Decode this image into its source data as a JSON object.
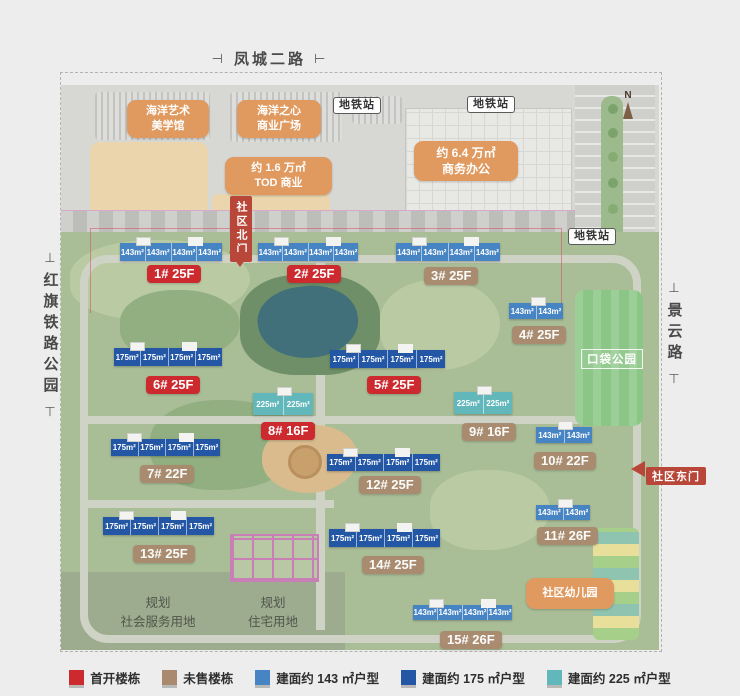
{
  "colors": {
    "first": "#cc2a2f",
    "unsold": "#a98a6e",
    "u143": "#4684c4",
    "u175": "#2357a6",
    "u225": "#62b7bb",
    "orange": "#e0995e",
    "gate": "#b8473a",
    "park": "#8cc687"
  },
  "roads": {
    "top": "凤城二路",
    "left": "红旗铁路公园",
    "right": "景云路",
    "tick_h_left": "⊣",
    "tick_h_right": "⊢",
    "tick_v_top": "⊥",
    "tick_v_bottom": "⊤"
  },
  "facilities": {
    "art_museum": "海洋艺术\n美学馆",
    "ocean_mall": "海洋之心\n商业广场",
    "tod": "约 1.6 万㎡\nTOD 商业",
    "office": "约 6.4 万㎡\n商务办公",
    "metro": "地铁站",
    "north_gate": "社区北门",
    "east_gate": "社区东门",
    "pocket_park": "口袋公园",
    "kindergarten": "社区幼儿园",
    "plan_service": "规划\n社会服务用地",
    "plan_residential": "规划\n住宅用地",
    "compass": "N"
  },
  "buildings": {
    "b1": {
      "label": "1# 25F",
      "status": "首开楼栋",
      "units": [
        "143m²",
        "143m²",
        "143m²",
        "143m²"
      ]
    },
    "b2": {
      "label": "2# 25F",
      "status": "首开楼栋",
      "units": [
        "143m²",
        "143m²",
        "143m²",
        "143m²"
      ]
    },
    "b3": {
      "label": "3# 25F",
      "status": "未售楼栋",
      "units": [
        "143m²",
        "143m²",
        "143m²",
        "143m²"
      ]
    },
    "b4": {
      "label": "4# 25F",
      "status": "未售楼栋",
      "units": [
        "143m²",
        "143m²"
      ]
    },
    "b5": {
      "label": "5# 25F",
      "status": "首开楼栋",
      "units": [
        "175m²",
        "175m²",
        "175m²",
        "175m²"
      ]
    },
    "b6": {
      "label": "6# 25F",
      "status": "首开楼栋",
      "units": [
        "175m²",
        "175m²",
        "175m²",
        "175m²"
      ]
    },
    "b7": {
      "label": "7# 22F",
      "status": "未售楼栋",
      "units": [
        "175m²",
        "175m²",
        "175m²",
        "175m²"
      ]
    },
    "b8": {
      "label": "8# 16F",
      "status": "首开楼栋",
      "units": [
        "225m²",
        "225m²"
      ]
    },
    "b9": {
      "label": "9# 16F",
      "status": "未售楼栋",
      "units": [
        "225m²",
        "225m²"
      ]
    },
    "b10": {
      "label": "10# 22F",
      "status": "未售楼栋",
      "units": [
        "143m²",
        "143m²"
      ]
    },
    "b11": {
      "label": "11# 26F",
      "status": "未售楼栋",
      "units": [
        "143m²",
        "143m²"
      ]
    },
    "b12": {
      "label": "12# 25F",
      "status": "未售楼栋",
      "units": [
        "175m²",
        "175m²",
        "175m²",
        "175m²"
      ]
    },
    "b13": {
      "label": "13# 25F",
      "status": "未售楼栋",
      "units": [
        "175m²",
        "175m²",
        "175m²",
        "175m²"
      ]
    },
    "b14": {
      "label": "14# 25F",
      "status": "未售楼栋",
      "units": [
        "175m²",
        "175m²",
        "175m²",
        "175m²"
      ]
    },
    "b15": {
      "label": "15# 26F",
      "status": "未售楼栋",
      "units": [
        "143m²",
        "143m²",
        "143m²",
        "143m²"
      ]
    }
  },
  "legend": {
    "items": [
      {
        "label": "首开楼栋"
      },
      {
        "label": "未售楼栋"
      },
      {
        "label": "建面约 143 ㎡户型"
      },
      {
        "label": "建面约 175 ㎡户型"
      },
      {
        "label": "建面约 225 ㎡户型"
      }
    ]
  }
}
